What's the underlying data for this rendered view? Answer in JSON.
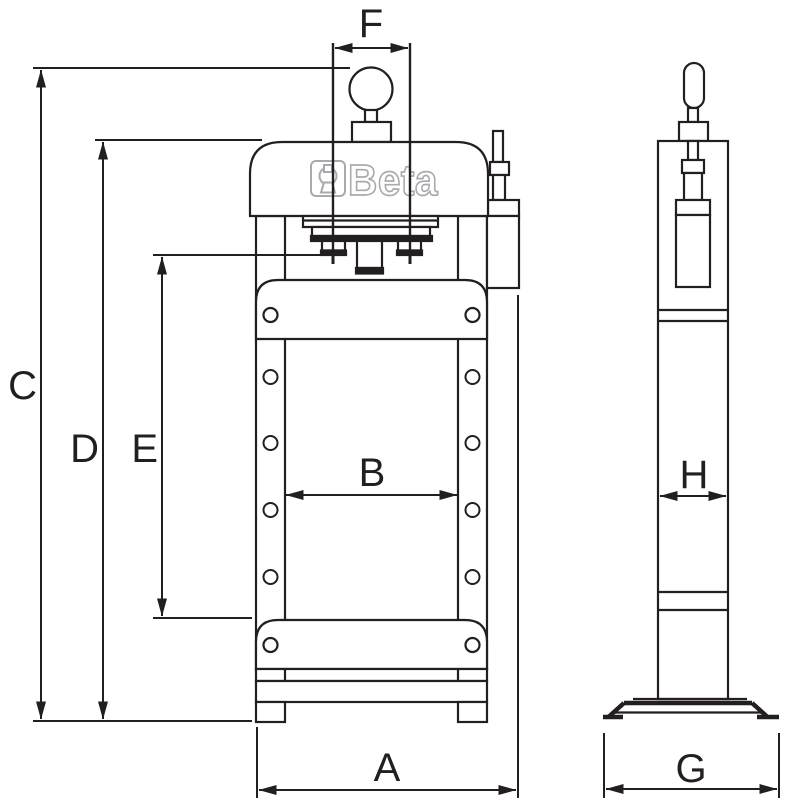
{
  "drawing": {
    "brand_logo": "Beta",
    "labels": {
      "A": "A",
      "B": "B",
      "C": "C",
      "D": "D",
      "E": "E",
      "F": "F",
      "G": "G",
      "H": "H"
    },
    "colors": {
      "background": "#ffffff",
      "line": "#231f20",
      "logo_outline": "#a8aaad"
    }
  }
}
